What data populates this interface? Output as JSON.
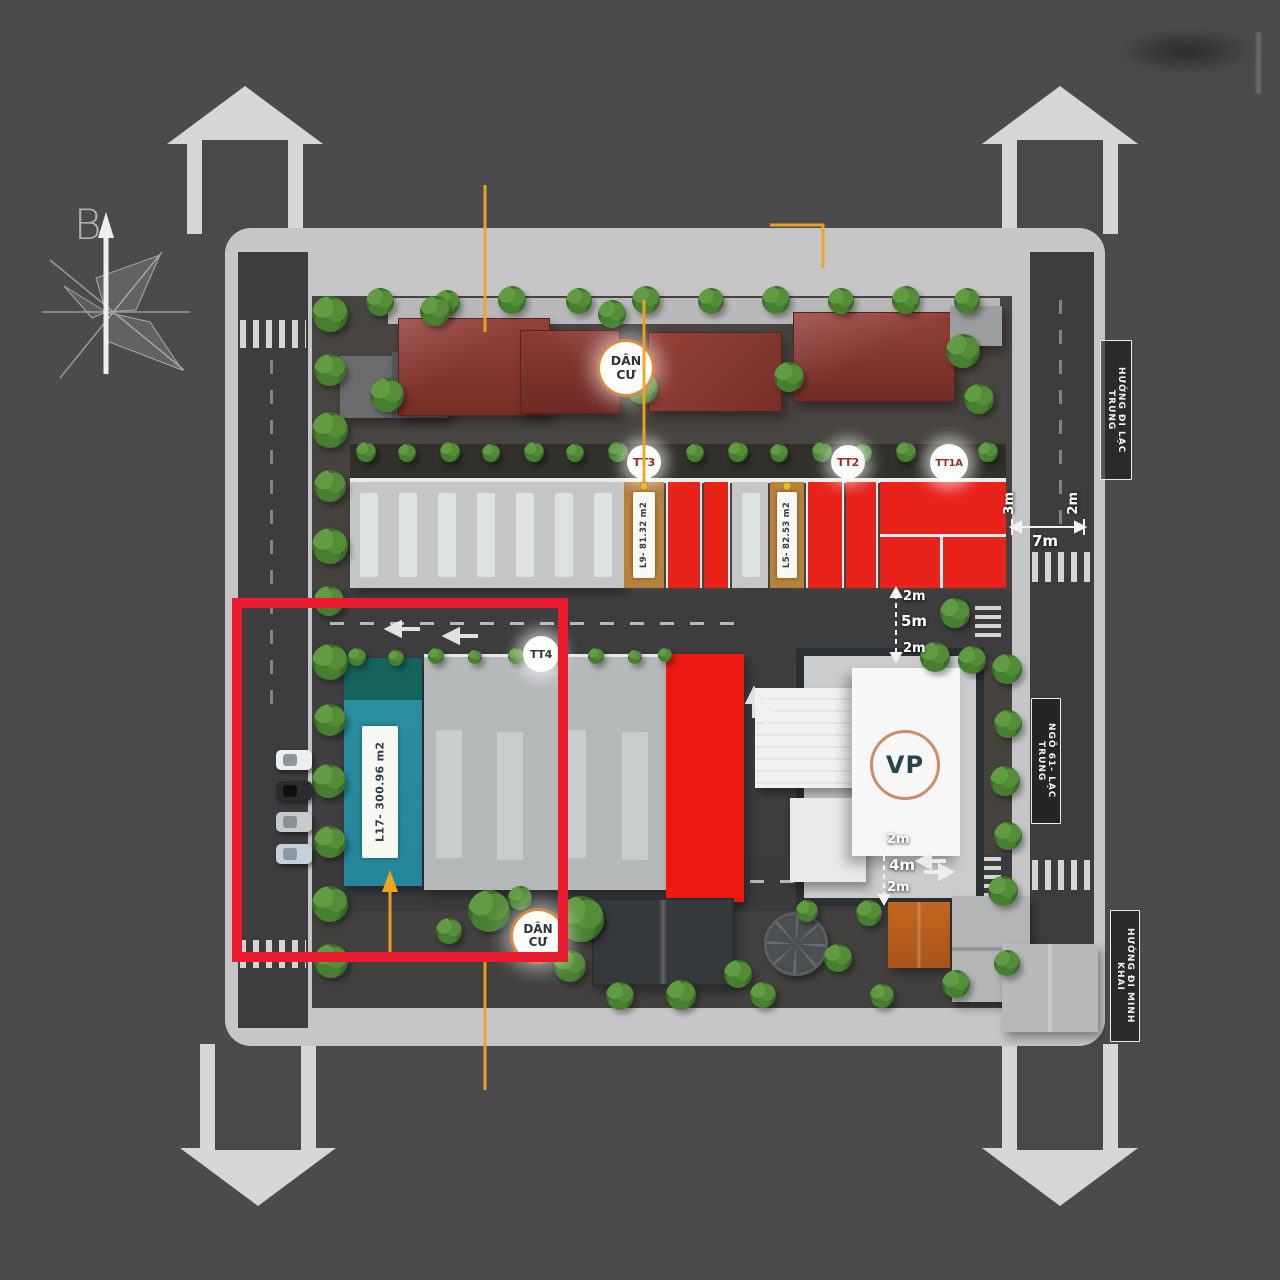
{
  "compass": {
    "north_label": "B"
  },
  "road_labels": {
    "top_right": "HƯỚNG ĐI LẠC TRUNG",
    "mid_right": "NGÕ 61- LẠC TRUNG",
    "bottom_right": "HƯỚNG ĐI MINH KHAI"
  },
  "badges": {
    "dan_cu_top": "DÂN CƯ",
    "tt3": "TT3",
    "tt2": "TT2",
    "tt1a": "TT1A",
    "tt4": "TT4",
    "vp": "VP",
    "dan_cu_bottom": "DÂN CƯ"
  },
  "unit_tags": {
    "l9": "L9- 81.32 m2",
    "l5": "L5- 82.53 m2",
    "l17": "L17- 300.96 m2"
  },
  "measurements": {
    "top_right": {
      "left": "3m",
      "width": "7m",
      "right": "2m"
    },
    "mid_road": {
      "top": "2m",
      "middle": "5m",
      "bottom": "2m"
    },
    "bottom_road": {
      "top": "2m",
      "middle": "4m",
      "bottom": "2m"
    }
  },
  "colors": {
    "background": "#4b4b4d",
    "sidewalk": "#c6c6c8",
    "road": "#3d3d3f",
    "highlight_box": "#ea1b2e",
    "unit_red": "#e8231a",
    "teal_building": "#2a8fa0",
    "tag_tan": "#b4803c",
    "badge_ring_orange": "#e08a3e",
    "leader_yellow": "#f0a41c",
    "tree_green": "#3b702c"
  }
}
